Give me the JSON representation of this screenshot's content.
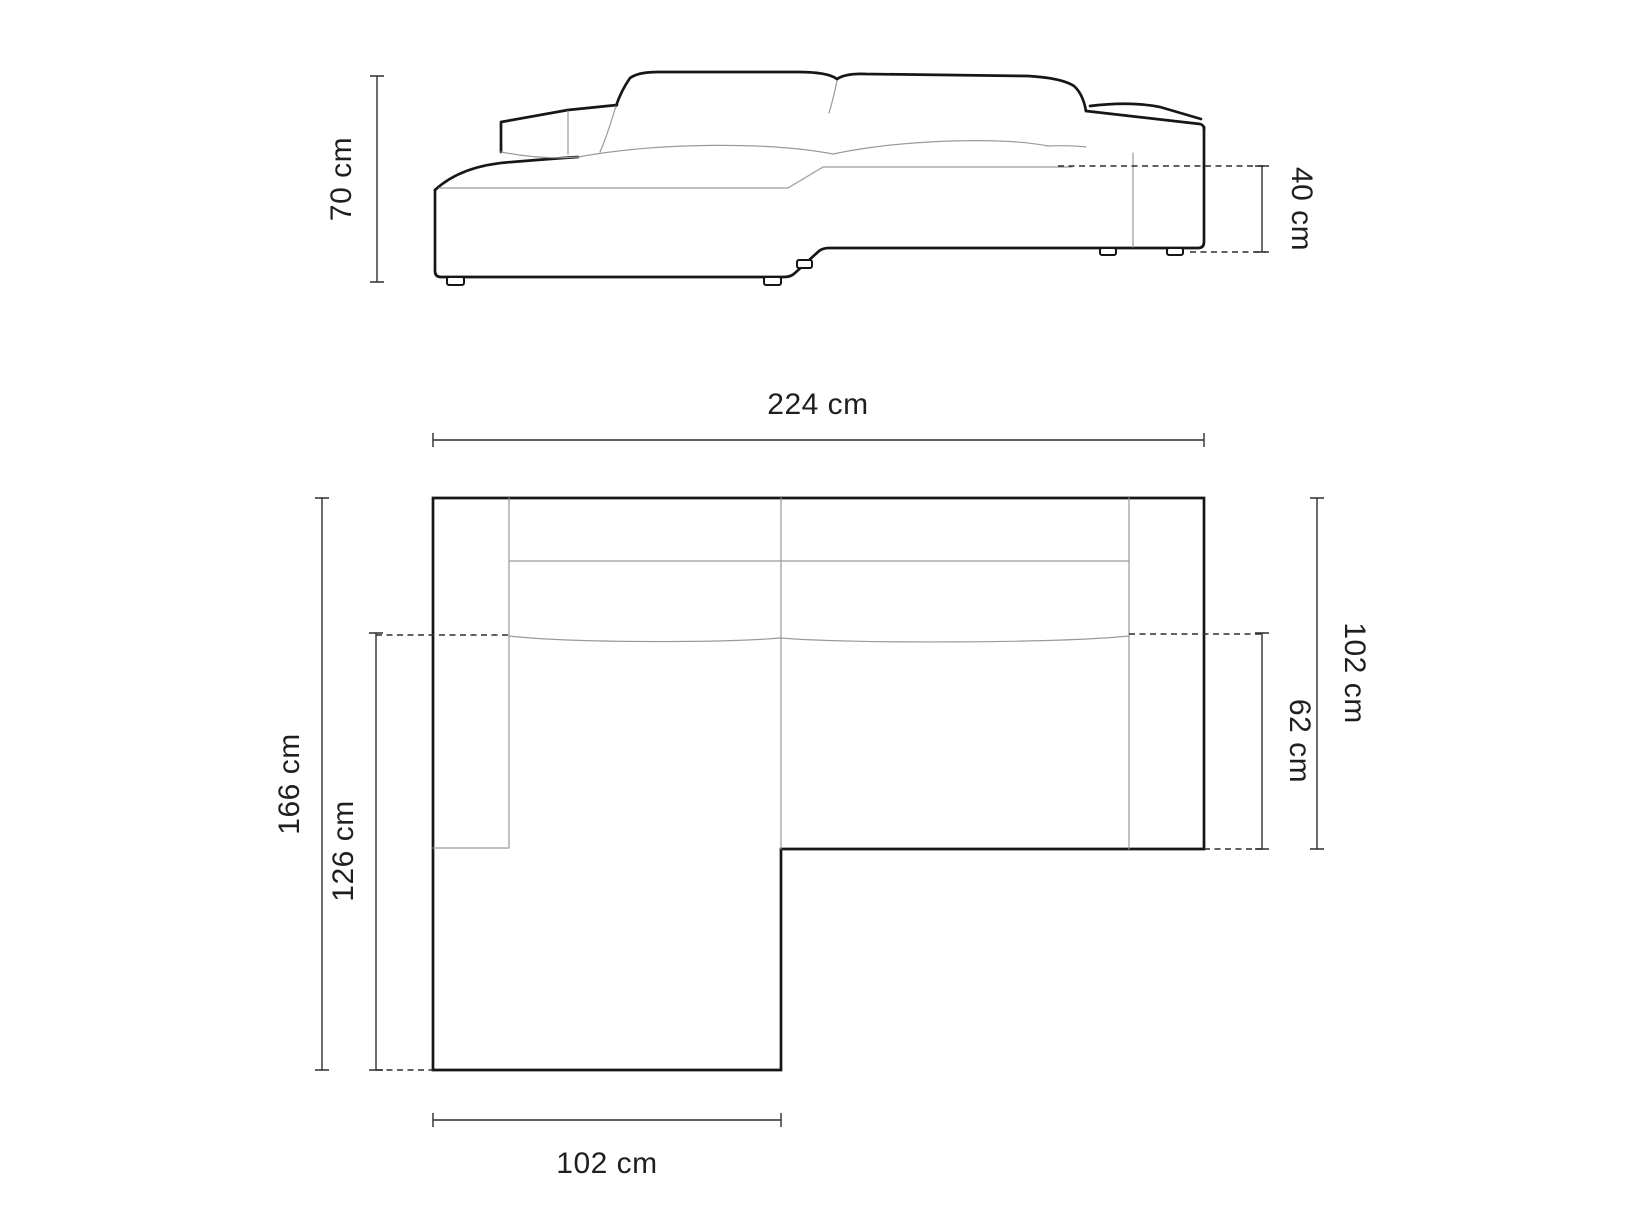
{
  "diagram": {
    "type": "sofa-dimension-drawing",
    "views": [
      "front-elevation",
      "top-plan"
    ],
    "colors": {
      "background": "#ffffff",
      "outline": "#161616",
      "thin_line": "#9a9a9a",
      "dimension_line": "#2e2e2e",
      "label_text": "#1f1f1f"
    }
  },
  "labels": {
    "height": "70 cm",
    "seat_height": "40 cm",
    "total_width": "224 cm",
    "total_depth": "166 cm",
    "chaise_depth": "126 cm",
    "side_depth": "102 cm",
    "seat_depth": "62 cm",
    "chaise_width": "102 cm"
  }
}
